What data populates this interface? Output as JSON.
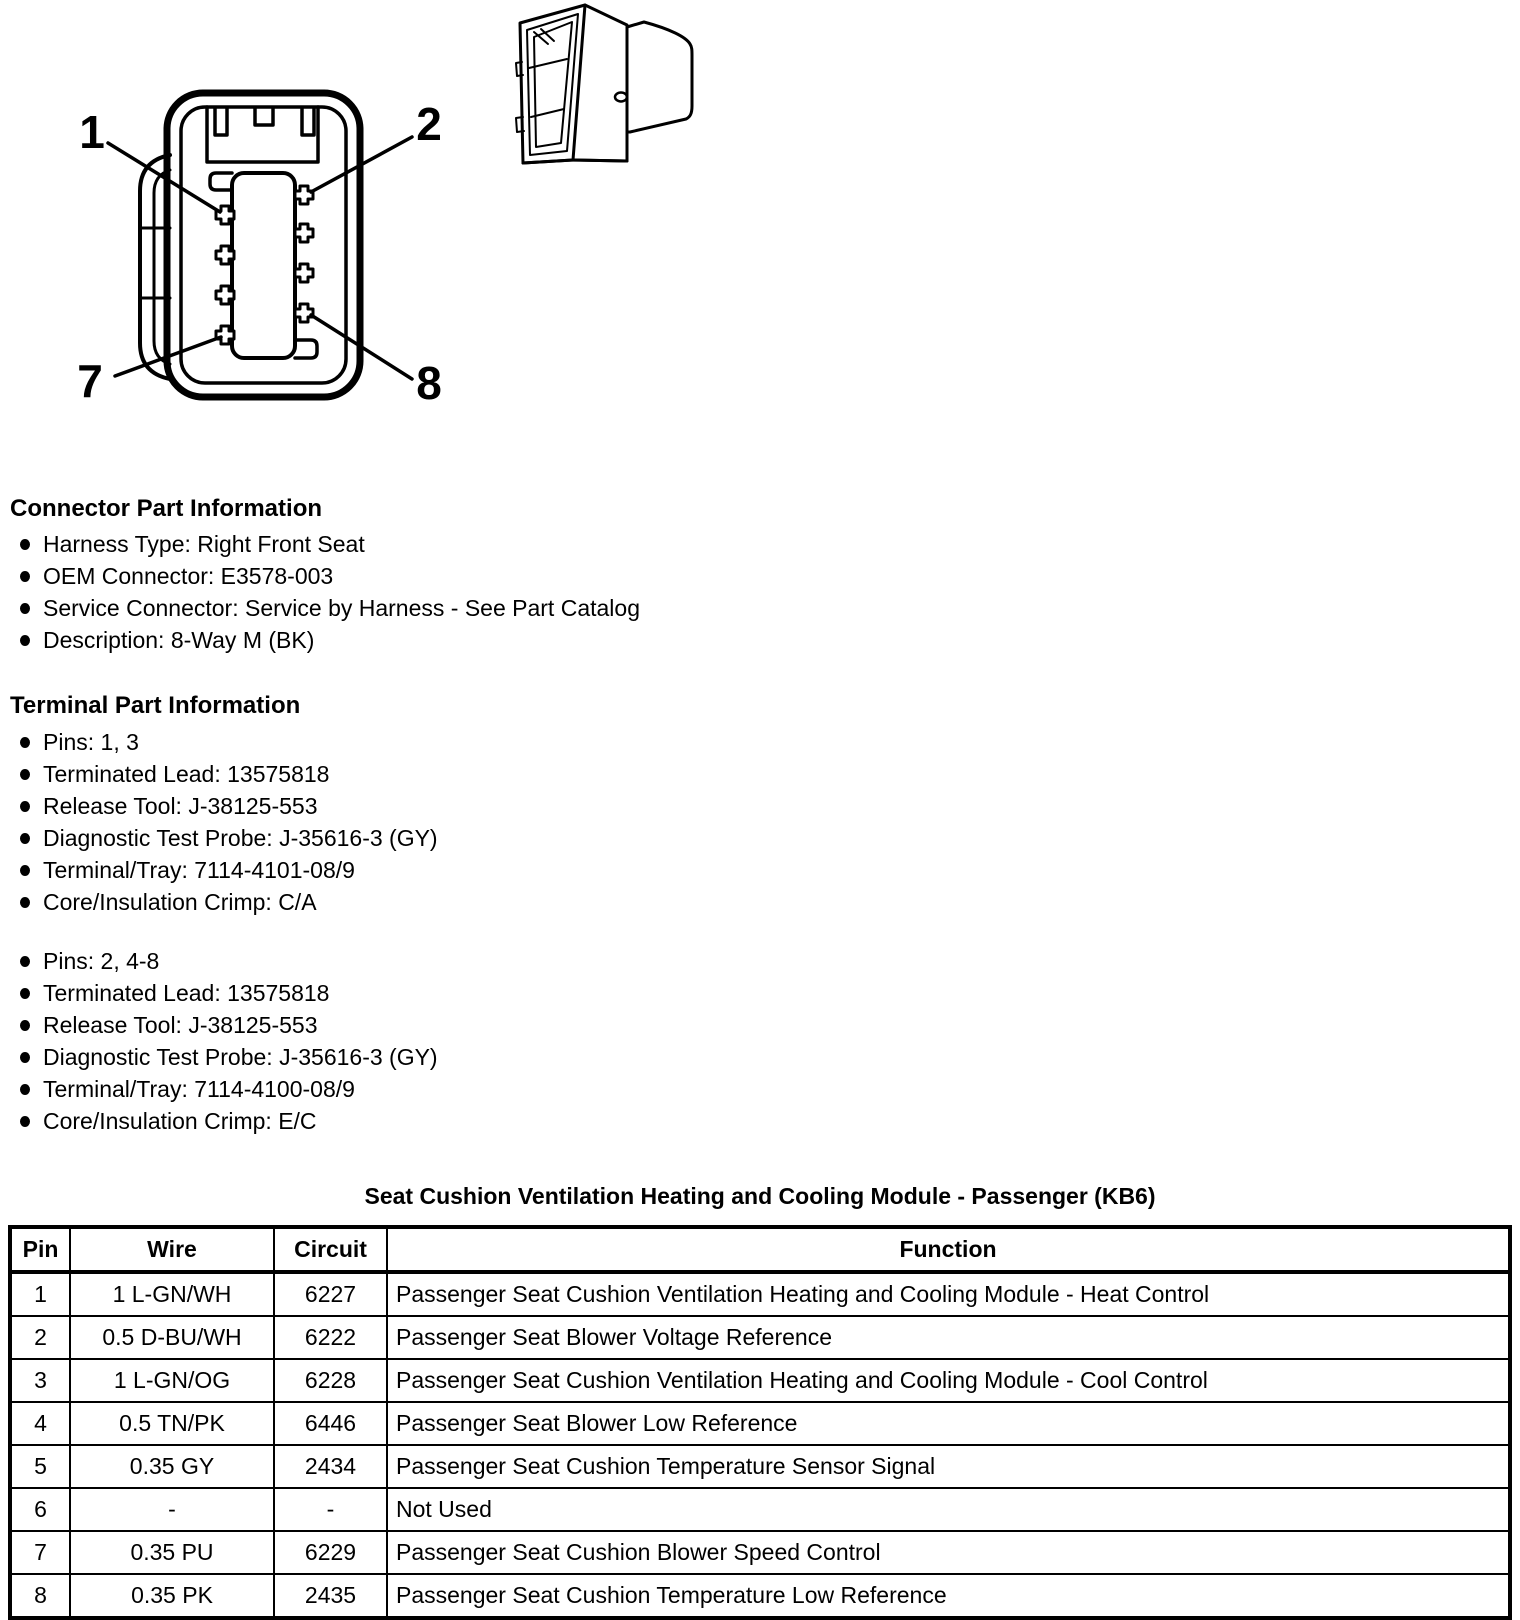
{
  "connector_diagram": {
    "pin_callouts": [
      "1",
      "2",
      "7",
      "8"
    ]
  },
  "sections": {
    "connector": {
      "heading": "Connector Part Information",
      "bullets": [
        "Harness Type: Right Front Seat",
        "OEM Connector: E3578-003",
        "Service Connector: Service by Harness - See Part Catalog",
        "Description: 8-Way M (BK)"
      ]
    },
    "terminal": {
      "heading": "Terminal Part Information",
      "groups": [
        [
          "Pins: 1, 3",
          "Terminated Lead: 13575818",
          "Release Tool: J-38125-553",
          "Diagnostic Test Probe: J-35616-3 (GY)",
          "Terminal/Tray: 7114-4101-08/9",
          "Core/Insulation Crimp: C/A"
        ],
        [
          "Pins: 2, 4-8",
          "Terminated Lead: 13575818",
          "Release Tool: J-38125-553",
          "Diagnostic Test Probe: J-35616-3 (GY)",
          "Terminal/Tray: 7114-4100-08/9",
          "Core/Insulation Crimp: E/C"
        ]
      ]
    }
  },
  "pinout_table": {
    "title": "Seat Cushion Ventilation Heating and Cooling Module - Passenger (KB6)",
    "columns": [
      "Pin",
      "Wire",
      "Circuit",
      "Function"
    ],
    "rows": [
      [
        "1",
        "1 L-GN/WH",
        "6227",
        "Passenger Seat Cushion Ventilation Heating and Cooling Module - Heat Control"
      ],
      [
        "2",
        "0.5 D-BU/WH",
        "6222",
        "Passenger Seat Blower Voltage Reference"
      ],
      [
        "3",
        "1 L-GN/OG",
        "6228",
        "Passenger Seat Cushion Ventilation Heating and Cooling Module - Cool Control"
      ],
      [
        "4",
        "0.5 TN/PK",
        "6446",
        "Passenger Seat Blower Low Reference"
      ],
      [
        "5",
        "0.35 GY",
        "2434",
        "Passenger Seat Cushion Temperature Sensor Signal"
      ],
      [
        "6",
        "-",
        "-",
        "Not Used"
      ],
      [
        "7",
        "0.35 PU",
        "6229",
        "Passenger Seat Cushion Blower Speed Control"
      ],
      [
        "8",
        "0.35 PK",
        "2435",
        "Passenger Seat Cushion Temperature Low Reference"
      ]
    ]
  }
}
